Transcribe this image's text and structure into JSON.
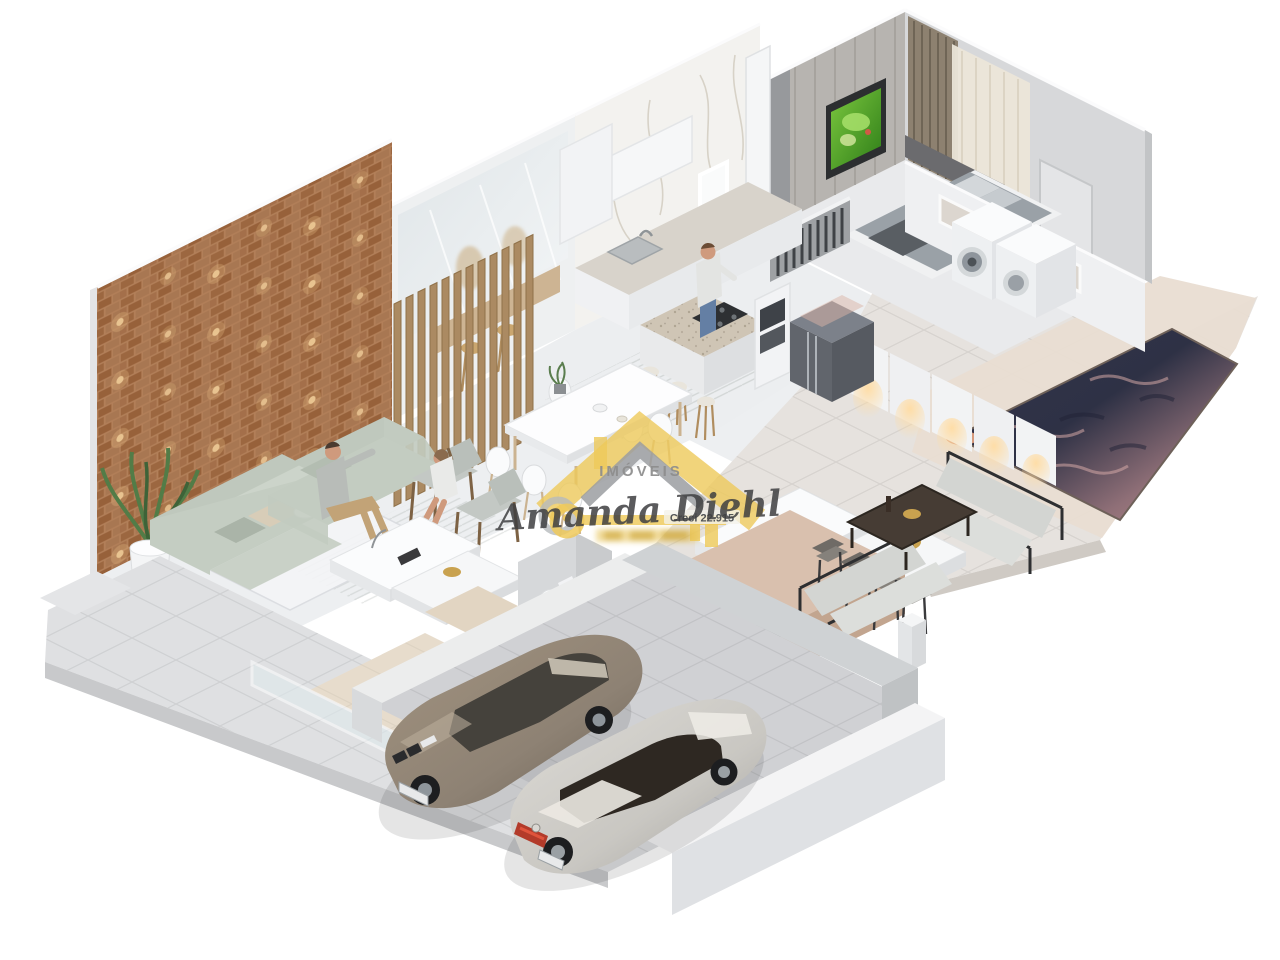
{
  "watermark": {
    "brand_top": "IMÓVEIS",
    "brand_name": "Amanda Diehl",
    "license": "Creci 22.915"
  },
  "palette": {
    "background": "#ffffff",
    "wall_white": "#f2f3f4",
    "wall_shadow": "#d8d9db",
    "brick_wall": "#b2794f",
    "brick_light": "#ffd7a0",
    "wood_slat": "#ab8a62",
    "floor_interior": "#edeff1",
    "floor_patio": "#e6e2de",
    "pool_deck": "#e9ddd2",
    "floor_garage": "#d0d1d4",
    "pool_deep": "#2e3145",
    "pool_shallow": "#bd8f8e",
    "sofa": "#c9d1c7",
    "bar_counter": "#d9c0ae",
    "island_top": "#cfc5b5",
    "fridge": "#5d6168",
    "tv_screen": "#55a32e",
    "car_suv": "#8e8274",
    "car_coupe": "#c9c7c2",
    "watermark_yellow": "#eec95a",
    "watermark_gray": "#9b9ea1",
    "curtain": "#8d8170",
    "plant": "#527c47"
  },
  "scene": {
    "type": "isometric 3d floor plan render",
    "objects": [
      "brick accent wall with spotlights",
      "wood slat partition",
      "sectional sofas",
      "wood armchairs",
      "coffee tables",
      "dining table with white chairs",
      "kitchen island with stools",
      "refrigerator",
      "oven tower",
      "bedroom with bed and tv",
      "curtains",
      "walk-in closet",
      "washer and dryer",
      "swimming pool",
      "outdoor lounge sofas",
      "gourmet bar with stools",
      "barbecue counter",
      "bathroom with toilet",
      "garage with two cars",
      "stairs",
      "potted plant",
      "four people"
    ]
  }
}
